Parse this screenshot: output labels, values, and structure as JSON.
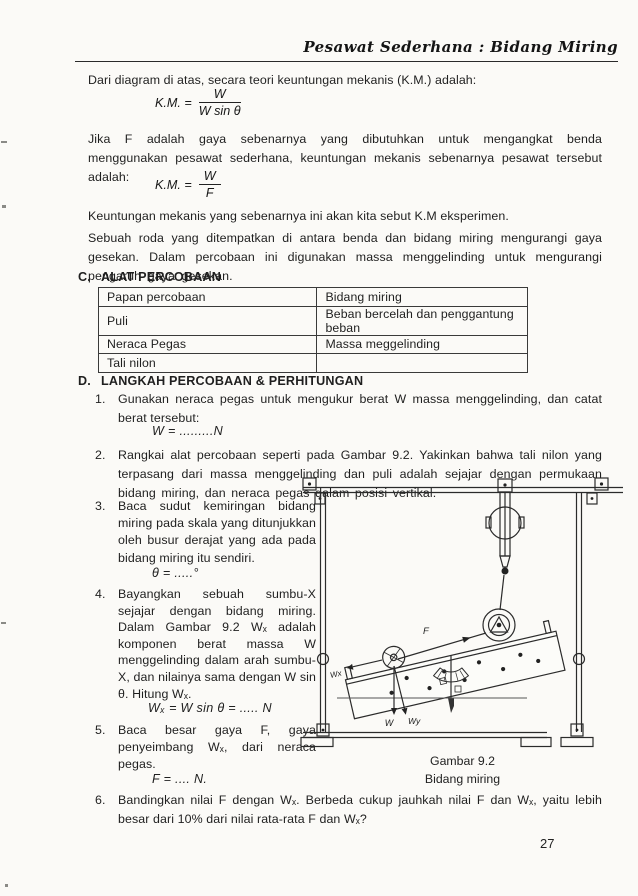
{
  "header": {
    "title": "Pesawat Sederhana : Bidang Miring"
  },
  "intro": {
    "p1": "Dari diagram di atas, secara teori keuntungan mekanis (K.M.) adalah:",
    "formula1": {
      "lhs": "K.M. =",
      "num": "W",
      "den": "W sin θ"
    },
    "p2": "Jika F adalah gaya sebenarnya yang dibutuhkan untuk mengangkat benda menggunakan pesawat sederhana, keuntungan mekanis sebenarnya pesawat tersebut adalah:",
    "formula2": {
      "lhs": "K.M. =",
      "num": "W",
      "den": "F"
    },
    "p3": "Keuntungan mekanis yang sebenarnya ini akan kita sebut K.M eksperimen.",
    "p4": "Sebuah roda yang ditempatkan di antara benda dan bidang miring mengurangi gaya gesekan. Dalam percobaan ini digunakan massa menggelinding untuk mengurangi pengaruh gaya gesekan."
  },
  "section_c": {
    "label": "C.",
    "title": "ALAT PERCOBAAN",
    "table_rows": [
      {
        "left": "Papan percobaan",
        "right": "Bidang miring"
      },
      {
        "left": "Puli",
        "right": "Beban bercelah dan penggantung beban"
      },
      {
        "left": "Neraca Pegas",
        "right": "Massa meggelinding"
      },
      {
        "left": "Tali nilon",
        "right": ""
      }
    ]
  },
  "section_d": {
    "label": "D.",
    "title": "LANGKAH PERCOBAAN & PERHITUNGAN",
    "steps": [
      {
        "num": "1.",
        "text": "Gunakan neraca pegas untuk mengukur berat W massa menggelinding, dan catat berat tersebut:",
        "formula": "W = .........N"
      },
      {
        "num": "2.",
        "text": "Rangkai alat percobaan seperti pada Gambar 9.2. Yakinkan bahwa tali nilon yang terpasang dari massa menggelinding dan puli adalah sejajar dengan permukaan bidang miring, dan neraca pegas dalam posisi vertikal."
      },
      {
        "num": "3.",
        "text": "Baca sudut kemiringan bidang miring pada skala yang ditunjukkan oleh busur derajat yang ada pada bidang miring itu sendiri.",
        "formula": "θ = .....°"
      },
      {
        "num": "4.",
        "text": "Bayangkan sebuah sumbu-X sejajar dengan bidang miring. Dalam Gambar 9.2 Wₓ adalah komponen berat massa W menggelinding dalam arah sumbu-X, dan nilainya sama dengan W sin θ. Hitung Wₓ.",
        "formula": "Wₓ = W sin θ = ..... N"
      },
      {
        "num": "5.",
        "text": "Baca besar gaya F, gaya penyeimbang Wₓ, dari neraca pegas.",
        "formula": "F = .... N."
      },
      {
        "num": "6.",
        "text": "Bandingkan nilai F dengan Wₓ. Berbeda cukup jauhkah nilai F dan Wₓ, yaitu lebih besar dari 10% dari nilai rata-rata F dan Wₓ?"
      }
    ]
  },
  "figure": {
    "caption1": "Gambar 9.2",
    "caption2": "Bidang miring",
    "labels": {
      "f": "F",
      "wx": "Wx",
      "w": "W",
      "wy": "Wy"
    }
  },
  "page_number": "27"
}
